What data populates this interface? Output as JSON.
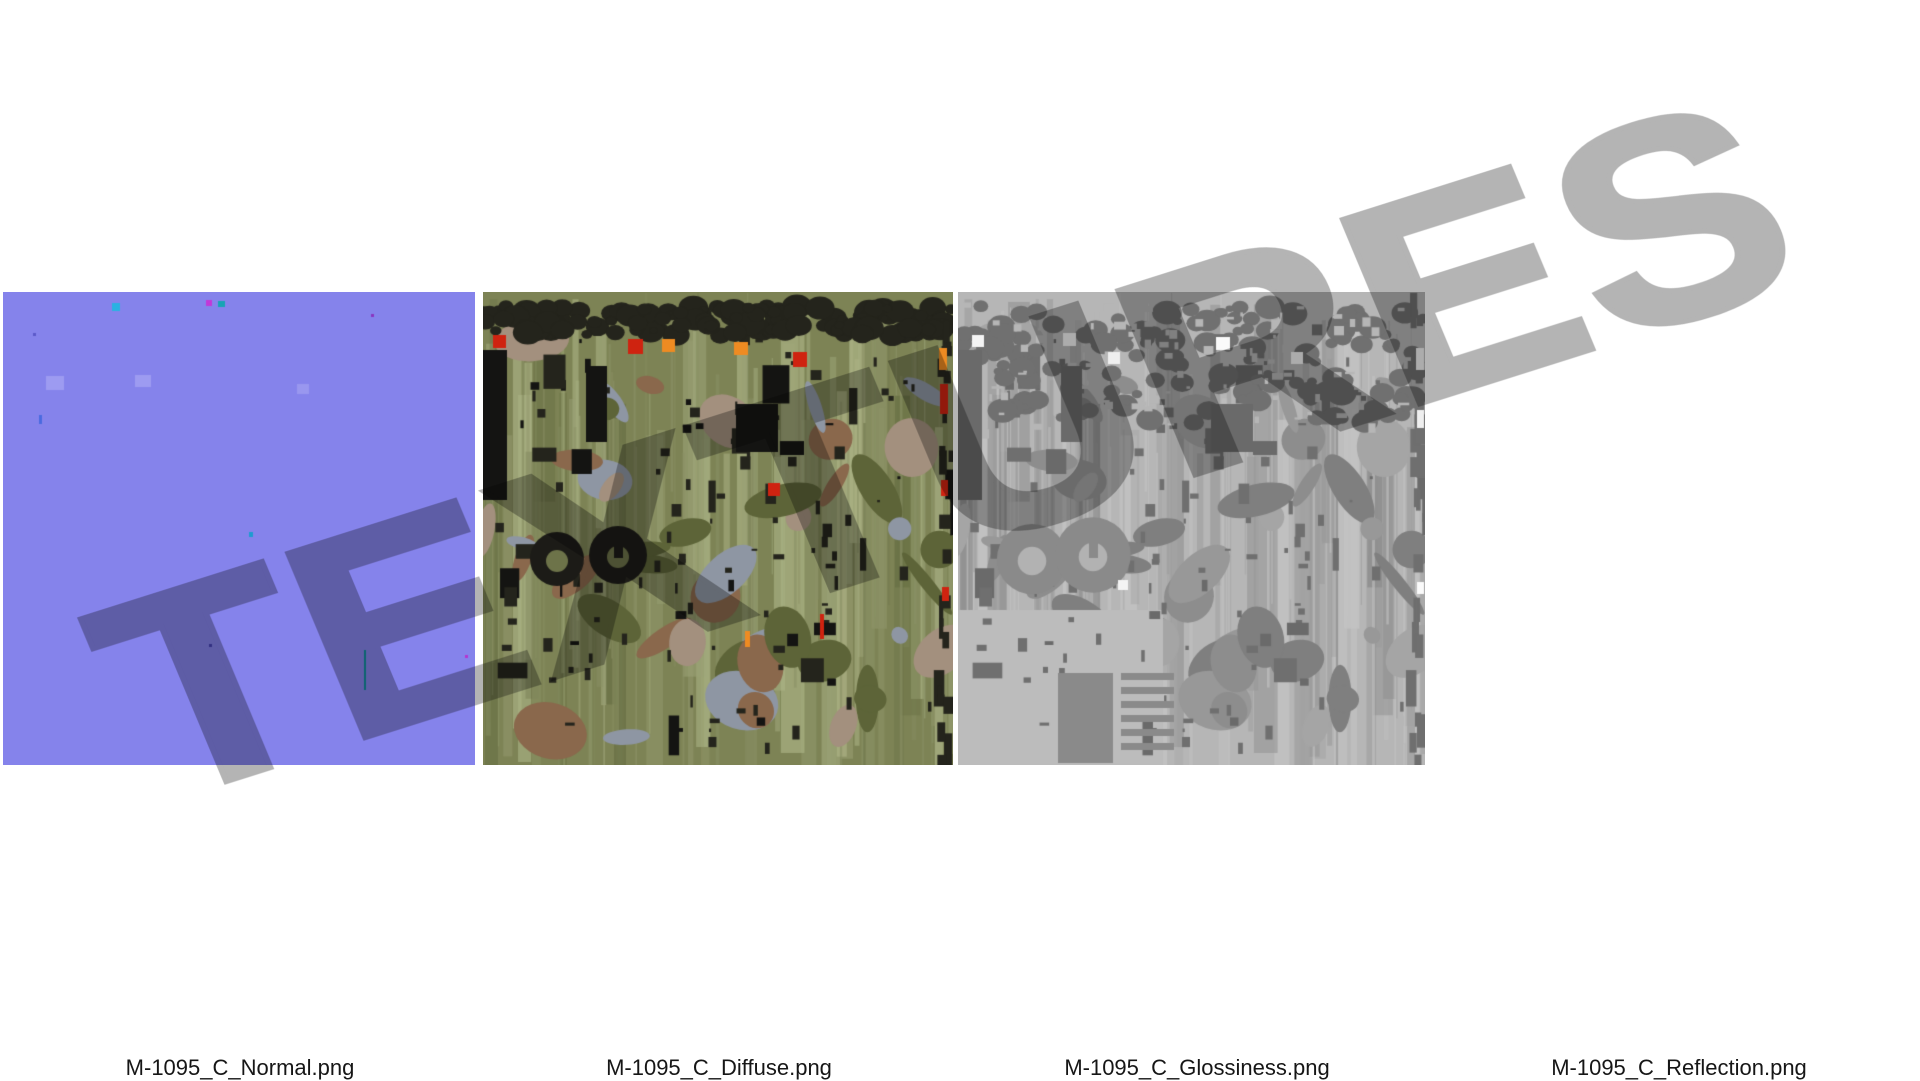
{
  "page": {
    "background": "#ffffff"
  },
  "watermark": {
    "text": "TEXTURES",
    "color": "#b4b4b4"
  },
  "textures": [
    {
      "id": "normal",
      "filename": "M-1095_C_Normal.png",
      "kind": "normal-map",
      "render": {
        "style": "flat",
        "base": "#8583eb",
        "specks": [
          {
            "x": 109,
            "y": 11,
            "w": 8,
            "h": 8,
            "c": "#29b2e2"
          },
          {
            "x": 203,
            "y": 8,
            "w": 6,
            "h": 6,
            "c": "#c238d8"
          },
          {
            "x": 215,
            "y": 9,
            "w": 7,
            "h": 6,
            "c": "#17a4b4"
          },
          {
            "x": 30,
            "y": 41,
            "w": 3,
            "h": 3,
            "c": "#5b59c9"
          },
          {
            "x": 36,
            "y": 123,
            "w": 3,
            "h": 9,
            "c": "#4a6ae0"
          },
          {
            "x": 43,
            "y": 84,
            "w": 18,
            "h": 14,
            "c": "#9d9bf1"
          },
          {
            "x": 132,
            "y": 83,
            "w": 16,
            "h": 12,
            "c": "#9d9bf1"
          },
          {
            "x": 294,
            "y": 92,
            "w": 12,
            "h": 10,
            "c": "#9visible"
          },
          {
            "x": 294,
            "y": 92,
            "w": 12,
            "h": 10,
            "c": "#9997ef"
          },
          {
            "x": 246,
            "y": 240,
            "w": 4,
            "h": 5,
            "c": "#1e9bd0"
          },
          {
            "x": 206,
            "y": 352,
            "w": 3,
            "h": 3,
            "c": "#4744b8"
          },
          {
            "x": 361,
            "y": 358,
            "w": 2,
            "h": 40,
            "c": "#0f8e9c"
          },
          {
            "x": 462,
            "y": 363,
            "w": 3,
            "h": 3,
            "c": "#b535cf"
          },
          {
            "x": 368,
            "y": 22,
            "w": 3,
            "h": 3,
            "c": "#8a35c0"
          }
        ]
      }
    },
    {
      "id": "diffuse",
      "filename": "M-1095_C_Diffuse.png",
      "kind": "diffuse-camouflage",
      "render": {
        "style": "detail",
        "base": "#7d8355",
        "stripes": [
          "#99a074",
          "#6a7246",
          "#8b9165",
          "#aab284"
        ],
        "patches": [
          "#8a684c",
          "#a3907e",
          "#5d6438",
          "#8e96a3"
        ],
        "dark": "#24241c",
        "black": "#141412",
        "tire": "#1c1b17",
        "tire_hole": "#6d7349",
        "topband_color": "#24241c",
        "topband_height": 42,
        "accents": [
          {
            "x": 10,
            "y": 43,
            "w": 13,
            "h": 13,
            "c": "#cf2310"
          },
          {
            "x": 145,
            "y": 47,
            "w": 15,
            "h": 15,
            "c": "#cf2310"
          },
          {
            "x": 179,
            "y": 47,
            "w": 13,
            "h": 13,
            "c": "#ee8b22"
          },
          {
            "x": 251,
            "y": 50,
            "w": 14,
            "h": 13,
            "c": "#ee8b22"
          },
          {
            "x": 310,
            "y": 60,
            "w": 14,
            "h": 15,
            "c": "#cf2310"
          },
          {
            "x": 285,
            "y": 191,
            "w": 12,
            "h": 13,
            "c": "#cf2310"
          },
          {
            "x": 262,
            "y": 339,
            "w": 5,
            "h": 16,
            "c": "#ee8b22"
          },
          {
            "x": 337,
            "y": 322,
            "w": 4,
            "h": 25,
            "c": "#cf2310"
          },
          {
            "x": 456,
            "y": 56,
            "w": 8,
            "h": 22,
            "c": "#ee8b22"
          },
          {
            "x": 457,
            "y": 92,
            "w": 8,
            "h": 30,
            "c": "#cf2310"
          },
          {
            "x": 458,
            "y": 188,
            "w": 7,
            "h": 16,
            "c": "#cf2310"
          },
          {
            "x": 459,
            "y": 295,
            "w": 7,
            "h": 14,
            "c": "#cf2310"
          }
        ]
      }
    },
    {
      "id": "glossiness",
      "filename": "M-1095_C_Glossiness.png",
      "kind": "glossiness-map",
      "render": {
        "style": "detail",
        "base": "#b6b6b6",
        "stripes": [
          "#a2a2a2",
          "#8f8f8f",
          "#c3c3c3",
          "#9a9a9a"
        ],
        "patches": [
          "#8d8d8d",
          "#a5a5a5",
          "#7f7f7f",
          "#989898"
        ],
        "dark": "#6f6f6f",
        "black": "#6a6a6a",
        "tire": "#8a8a8a",
        "tire_hole": "#b2b2b2",
        "tire_scale": 1.3,
        "topband_color": "#707070",
        "topband_height": 130,
        "flat_corner": {
          "x": 0,
          "y": 318,
          "w": 205,
          "h": 155,
          "c": "#bcbcbc"
        },
        "dark_block": {
          "x": 100,
          "y": 381,
          "w": 55,
          "h": 90,
          "c": "#8a8a8a"
        },
        "ladder": {
          "x": 163,
          "y": 381,
          "w": 53,
          "h": 77,
          "c": "#8a8a8a"
        },
        "accents": [
          {
            "x": 14,
            "y": 43,
            "w": 12,
            "h": 12,
            "c": "#f4f4f4"
          },
          {
            "x": 105,
            "y": 41,
            "w": 13,
            "h": 13,
            "c": "#f4f4f4"
          },
          {
            "x": 150,
            "y": 60,
            "w": 12,
            "h": 12,
            "c": "#efefef"
          },
          {
            "x": 258,
            "y": 45,
            "w": 14,
            "h": 13,
            "c": "#fafafa"
          },
          {
            "x": 333,
            "y": 60,
            "w": 12,
            "h": 12,
            "c": "#f4f4f4"
          },
          {
            "x": 458,
            "y": 56,
            "w": 8,
            "h": 22,
            "c": "#f4f4f4"
          },
          {
            "x": 459,
            "y": 118,
            "w": 7,
            "h": 18,
            "c": "#efefef"
          },
          {
            "x": 160,
            "y": 288,
            "w": 10,
            "h": 10,
            "c": "#f4f4f4"
          },
          {
            "x": 459,
            "y": 290,
            "w": 7,
            "h": 12,
            "c": "#fafafa"
          }
        ]
      }
    },
    {
      "id": "reflection",
      "filename": "M-1095_C_Reflection.png",
      "kind": "reflection-map",
      "render": {
        "style": "flat",
        "base": "#ffffff",
        "specks": []
      }
    }
  ]
}
